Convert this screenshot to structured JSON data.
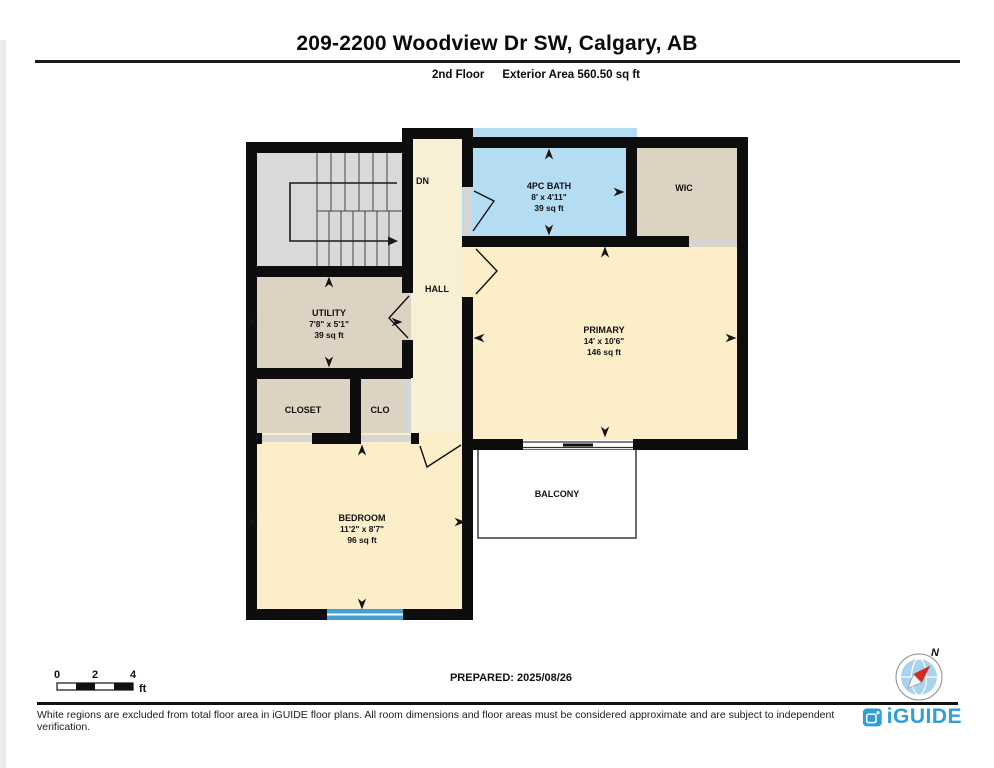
{
  "header": {
    "title": "209-2200 Woodview Dr SW, Calgary, AB",
    "floor_label": "2nd Floor",
    "area_label": "Exterior Area 560.50 sq ft"
  },
  "plan": {
    "stairs": {
      "direction_label": "DN"
    },
    "hall": {
      "name": "HALL"
    },
    "bath": {
      "name": "4PC BATH",
      "dims": "8' x 4'11\"",
      "area": "39 sq ft"
    },
    "wic": {
      "name": "WIC"
    },
    "utility": {
      "name": "UTILITY",
      "dims": "7'8\" x 5'1\"",
      "area": "39 sq ft"
    },
    "primary": {
      "name": "PRIMARY",
      "dims": "14' x 10'6\"",
      "area": "146 sq ft"
    },
    "closet": {
      "name": "CLOSET"
    },
    "clo": {
      "name": "CLO"
    },
    "bedroom": {
      "name": "BEDROOM",
      "dims": "11'2\" x 8'7\"",
      "area": "96 sq ft"
    },
    "balcony": {
      "name": "BALCONY"
    }
  },
  "scale_bar": {
    "ticks": [
      "0",
      "2",
      "4"
    ],
    "unit": "ft"
  },
  "prepared_label": "PREPARED: 2025/08/26",
  "compass": {
    "north_label": "N"
  },
  "footer": {
    "disclaimer": "White regions are excluded from total floor area in iGUIDE floor plans. All room dimensions and floor areas must be considered approximate and are subject to independent verification.",
    "brand": "iGUIDE"
  },
  "colors": {
    "wall": "#0d0d0d",
    "room_cream": "#fbeec9",
    "hall_cream": "#f8f0d5",
    "bath_blue": "#b4ddf3",
    "closet_tan": "#ddd3c3",
    "stairs_gray": "#d9d9d9",
    "window_blue": "#3da0d6",
    "brand_blue": "#2f9fd7"
  }
}
